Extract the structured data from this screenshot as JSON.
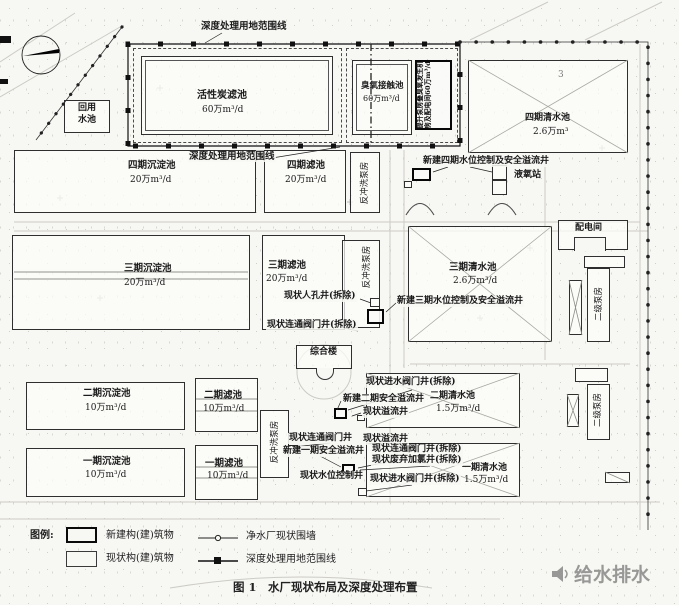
{
  "boundary": {
    "top_label": "深度处理用地范围线",
    "mid_label": "深度处理用地范围线"
  },
  "site_number": "3",
  "buildings": {
    "activated_carbon": {
      "name": "活性炭滤池",
      "capacity": "60万m³/d"
    },
    "reuse_tank": {
      "line1": "回用",
      "line2": "水池"
    },
    "ozone_contact": {
      "name": "臭氧接触池",
      "capacity": "60万m³/d"
    },
    "lift_pump_complex": {
      "name": "提升泵房叠臭氧发生机房及配电间60万m³/d"
    },
    "phase4_clearwater": {
      "name": "四期清水池",
      "capacity": "2.6万m³"
    },
    "phase4_sedimentation": {
      "name": "四期沉淀池",
      "capacity": "20万m³/d"
    },
    "phase4_filter": {
      "name": "四期滤池",
      "capacity": "20万m³/d"
    },
    "backwash_pump_1": {
      "name": "反冲洗泵房"
    },
    "backwash_pump_2": {
      "name": "反冲洗泵房"
    },
    "backwash_pump_3": {
      "name": "反冲洗泵房"
    },
    "liquid_oxygen": {
      "name": "液氧站"
    },
    "power_room": {
      "name": "配电间"
    },
    "phase3_sedimentation": {
      "name": "三期沉淀池",
      "capacity": "20万m³/d"
    },
    "phase3_filter": {
      "name": "三期滤池",
      "capacity": "20万m³/d"
    },
    "phase3_clearwater": {
      "name": "三期清水池",
      "capacity": "2.6万m³/d"
    },
    "complex_building": {
      "name": "综合楼"
    },
    "phase2_sedimentation": {
      "name": "二期沉淀池",
      "capacity": "10万m³/d"
    },
    "phase2_filter": {
      "name": "二期滤池",
      "capacity": "10万m³/d"
    },
    "phase1_sedimentation": {
      "name": "一期沉淀池",
      "capacity": "10万m³/d"
    },
    "phase1_filter": {
      "name": "一期滤池",
      "capacity": "10万m³/d"
    },
    "phase2_clearwater": {
      "name": "二期清水池",
      "capacity": "1.5万m³/d"
    },
    "phase1_clearwater": {
      "name": "一期清水池",
      "capacity": "1.5万m³/d"
    },
    "secondary_pump_1": {
      "name": "二级泵房"
    },
    "secondary_pump_2": {
      "name": "二级泵房"
    }
  },
  "annotations": {
    "phase4_overflow": "新建四期水位控制及安全溢流井",
    "phase3_overflow": "新建三期水位控制及安全溢流井",
    "manhole_demolish": "现状人孔井(拆除)",
    "connect_valve_demolish": "现状连通阀门井(拆除)",
    "inlet_valve_demolish_top": "现状进水阀门井(拆除)",
    "new_phase2_overflow": "新建二期安全溢流井",
    "existing_overflow_a": "现状溢流井",
    "existing_connect_valve": "现状连通阀门井",
    "existing_overflow_b": "现状溢流井",
    "new_phase1_overflow": "新建一期安全溢流井",
    "connect_valve_demolish_2": "现状连通阀门井(拆除)",
    "chlorine_well_demolish": "现状废弃加氯井(拆除)",
    "water_level_well": "现状水位控制井",
    "inlet_valve_demolish_bottom": "现状进水阀门井(拆除)"
  },
  "legend": {
    "title": "图例:",
    "items": [
      {
        "label": "新建构(建)筑物",
        "symbol": "new-structure"
      },
      {
        "label": "现状构(建)筑物",
        "symbol": "existing-structure"
      },
      {
        "label": "净水厂现状围墙",
        "symbol": "fence-line"
      },
      {
        "label": "深度处理用地范围线",
        "symbol": "deep-treatment-boundary-line"
      }
    ]
  },
  "caption": "图 1　水厂现状布局及深度处理布置",
  "watermark": {
    "text": "给水排水"
  }
}
